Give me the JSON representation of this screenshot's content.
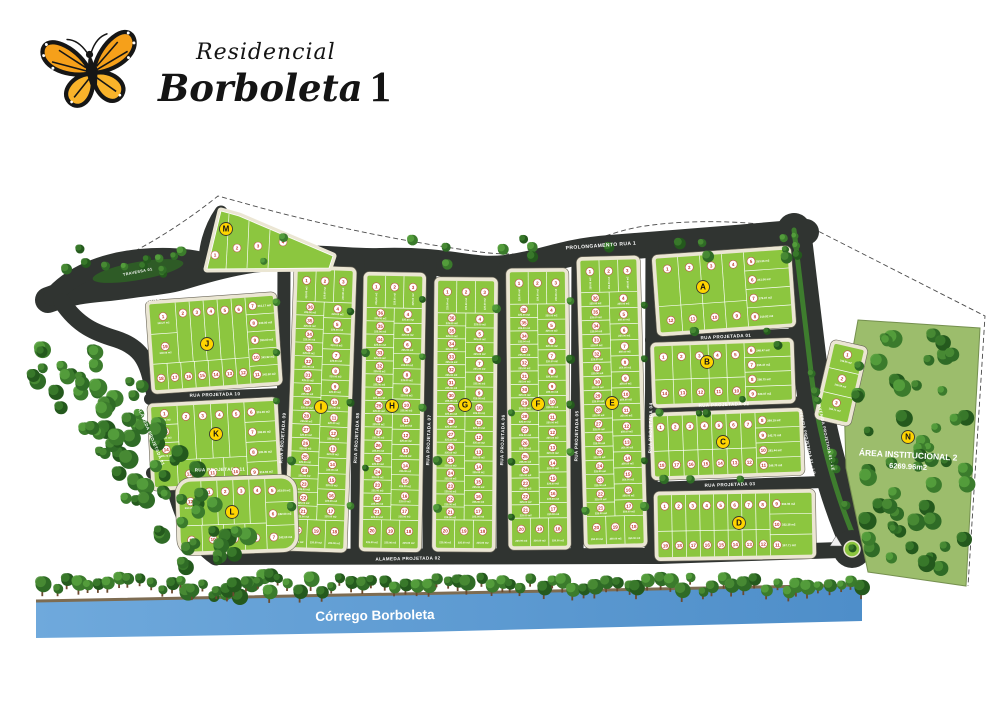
{
  "title": "Residencial Borboleta 1",
  "logo": {
    "script_line": "Residencial",
    "name_line": "Borboleta",
    "number": "1"
  },
  "map": {
    "colors": {
      "block_green": "#8CC63F",
      "road": "#303431",
      "sidewalk": "#EBE6D3",
      "badge_yellow": "#FFD400",
      "lot_number_red": "#C0392B",
      "river_light": "#6FA9DC",
      "river_dark": "#4E8EC9"
    },
    "river": {
      "label": "Córrego Borboleta"
    },
    "institutional_area": {
      "badge": "N",
      "badge_x": 908,
      "badge_y": 437,
      "x": 908,
      "y": 458,
      "rot": 3,
      "line1": "ÁREA INSTITUCIONAL 2",
      "line2": "6269.96m2"
    },
    "streets": [
      {
        "name": "PROLONGAMENTO RUA 1",
        "x": 168,
        "y": 298,
        "rot": -11,
        "size": 5
      },
      {
        "name": "PROLONGAMENTO RUA 1",
        "x": 601,
        "y": 247,
        "rot": -4,
        "size": 5
      },
      {
        "name": "TRAVESSA 01",
        "x": 138,
        "y": 273,
        "rot": -11,
        "size": 3.8
      },
      {
        "name": "RUA PROJETADA 10",
        "x": 215,
        "y": 396,
        "rot": -2,
        "size": 4.5
      },
      {
        "name": "RUA PROJETADA 11",
        "x": 220,
        "y": 471,
        "rot": -1,
        "size": 4.5
      },
      {
        "name": "RUA PROJETADA 09",
        "x": 284,
        "y": 438,
        "rot": -86,
        "size": 4.5
      },
      {
        "name": "RUA PROJETADA 08",
        "x": 358,
        "y": 438,
        "rot": -87,
        "size": 4.5
      },
      {
        "name": "RUA PROJETADA 07",
        "x": 430,
        "y": 440,
        "rot": -88,
        "size": 4.5
      },
      {
        "name": "RUA PROJETADA 06",
        "x": 504,
        "y": 440,
        "rot": -88,
        "size": 4.5
      },
      {
        "name": "RUA PROJETADA 05",
        "x": 578,
        "y": 436,
        "rot": -89,
        "size": 4.5
      },
      {
        "name": "RUA PROJETADA 04",
        "x": 652,
        "y": 428,
        "rot": -89,
        "size": 4.5
      },
      {
        "name": "RUA PROJETADA 01",
        "x": 726,
        "y": 338,
        "rot": -3,
        "size": 4.5
      },
      {
        "name": "RUA PROJETADA 02",
        "x": 724,
        "y": 406,
        "rot": -2,
        "size": 4.5
      },
      {
        "name": "RUA PROJETADA 03",
        "x": 730,
        "y": 486,
        "rot": -2,
        "size": 4.5
      },
      {
        "name": "AVENIDA PROJETADA 01 - LD",
        "x": 806,
        "y": 442,
        "rot": 78,
        "size": 4
      },
      {
        "name": "AVENIDA PROJETADA 01 - LE",
        "x": 825,
        "y": 438,
        "rot": 78,
        "size": 4
      },
      {
        "name": "ALAMEDA PROJETADA 01",
        "x": 150,
        "y": 437,
        "rot": 67,
        "size": 4.3
      },
      {
        "name": "ALAMEDA PROJETADA 02",
        "x": 408,
        "y": 560,
        "rot": -1,
        "size": 4.5
      }
    ],
    "strip_numbering": {
      "top": [
        "1",
        "2",
        "3"
      ],
      "bottom": [
        "20",
        "19",
        "18"
      ],
      "right_start": 4,
      "right_count": 14,
      "left_start": 21,
      "left_count": 16
    },
    "strip_blocks": [
      {
        "letter": "I",
        "badge": [
          321,
          407
        ],
        "x": 293,
        "y": 270,
        "w": 55,
        "h": 278,
        "rot": 2,
        "areaL": "225.00 m2",
        "areaR": "220.00 m2"
      },
      {
        "letter": "H",
        "badge": [
          392,
          406
        ],
        "x": 365,
        "y": 276,
        "w": 55,
        "h": 272,
        "rot": 1,
        "areaL": "225.00 m2",
        "areaR": "225.00 m2"
      },
      {
        "letter": "G",
        "badge": [
          465,
          405
        ],
        "x": 437,
        "y": 281,
        "w": 56,
        "h": 267,
        "rot": 0.5,
        "areaL": "225.00 m2",
        "areaR": "225.00 m2"
      },
      {
        "letter": "F",
        "badge": [
          538,
          404
        ],
        "x": 511,
        "y": 272,
        "w": 55,
        "h": 274,
        "rot": -0.5,
        "areaL": "225.00 m2",
        "areaR": "220.00 m2"
      },
      {
        "letter": "E",
        "badge": [
          612,
          403
        ],
        "x": 584,
        "y": 260,
        "w": 56,
        "h": 284,
        "rot": -1.5,
        "areaL": "225.00 m2",
        "areaR": "250.00 m2"
      }
    ],
    "perimeter_blocks": [
      {
        "letter": "J",
        "badge": [
          207,
          344
        ],
        "x": 152,
        "y": 300,
        "w": 124,
        "h": 86,
        "rot": -4,
        "leftW": 26,
        "rightW": 28,
        "left": [
          [
            "1",
            "360.27 m2"
          ],
          [
            "19",
            "248.06 m2"
          ]
        ],
        "top": [
          "2",
          "3",
          "4",
          "5",
          "6"
        ],
        "right": [
          [
            "7",
            "361.17 m2"
          ],
          [
            "8",
            "330.00 m2"
          ],
          [
            "9",
            "330.00 m2"
          ],
          [
            "10",
            "343.92 m2"
          ],
          [
            "11",
            "342.92 m2"
          ]
        ],
        "bottom": [
          "18",
          "17",
          "16",
          "15",
          "14",
          "13",
          "12"
        ]
      },
      {
        "letter": "K",
        "badge": [
          216,
          434
        ],
        "x": 153,
        "y": 404,
        "w": 123,
        "h": 80,
        "rot": -3,
        "leftW": 26,
        "rightW": 30,
        "left": [
          [
            "1",
            "317.32 m2"
          ],
          [
            "15",
            "298.41 m2"
          ],
          [
            "14",
            "305.72 m2"
          ]
        ],
        "top": [
          "2",
          "3",
          "4",
          "5"
        ],
        "right": [
          [
            "6",
            "319.30 m2"
          ],
          [
            "7",
            "298.90 m2"
          ],
          [
            "8",
            "305.00 m2"
          ],
          [
            "9",
            "312.92 m2"
          ]
        ],
        "bottom": [
          "13",
          "12",
          "11",
          "10"
        ]
      },
      {
        "letter": "L",
        "badge": [
          232,
          512
        ],
        "x": 180,
        "y": 480,
        "w": 114,
        "h": 70,
        "rot": -2,
        "leftW": 22,
        "rightW": 28,
        "round": 12,
        "left": [
          [
            "12",
            "232.08 m2"
          ]
        ],
        "top": [
          "1",
          "2",
          "3",
          "4"
        ],
        "right": [
          [
            "5",
            "253.00 m2"
          ],
          [
            "6",
            "242.00 m2"
          ],
          [
            "7",
            "242.00 m2"
          ]
        ],
        "bottom": [
          "11",
          "10",
          "9",
          "8"
        ]
      },
      {
        "letter": "A",
        "badge": [
          703,
          287
        ],
        "x": 658,
        "y": 254,
        "w": 132,
        "h": 74,
        "rot": -4,
        "leftW": 0,
        "rightW": 44,
        "top": [
          "1",
          "2",
          "3",
          "4"
        ],
        "right": [
          [
            "5",
            "253.36 m2"
          ],
          [
            "6",
            "241.06 m2"
          ],
          [
            "7",
            "279.97 m2"
          ],
          [
            "8",
            "219.82 m2"
          ]
        ],
        "bottom": [
          "12",
          "11",
          "10",
          "9"
        ]
      },
      {
        "letter": "B",
        "badge": [
          707,
          362
        ],
        "x": 655,
        "y": 344,
        "w": 136,
        "h": 58,
        "rot": -2,
        "leftW": 0,
        "rightW": 46,
        "top": [
          "1",
          "2",
          "3",
          "4",
          "5"
        ],
        "right": [
          [
            "6",
            "248.47 m2"
          ],
          [
            "7",
            "295.47 m2"
          ],
          [
            "8",
            "298.75 m2"
          ],
          [
            "9",
            "320.07 m2"
          ]
        ],
        "bottom": [
          "14",
          "13",
          "12",
          "11",
          "10"
        ]
      },
      {
        "letter": "C",
        "badge": [
          723,
          442
        ],
        "x": 654,
        "y": 414,
        "w": 146,
        "h": 60,
        "rot": -2,
        "leftW": 0,
        "rightW": 44,
        "top": [
          "1",
          "2",
          "3",
          "4",
          "5",
          "6",
          "7"
        ],
        "right": [
          [
            "8",
            "299.19 m2"
          ],
          [
            "9",
            "242.75 m2"
          ],
          [
            "10",
            "281.44 m2"
          ],
          [
            "11",
            "246.70 m2"
          ]
        ],
        "bottom": [
          "18",
          "17",
          "16",
          "15",
          "14",
          "13",
          "12"
        ]
      },
      {
        "letter": "D",
        "badge": [
          739,
          523
        ],
        "x": 658,
        "y": 494,
        "w": 154,
        "h": 62,
        "rot": -1,
        "leftW": 0,
        "rightW": 42,
        "top": [
          "1",
          "2",
          "3",
          "4",
          "5",
          "6",
          "7",
          "8"
        ],
        "right": [
          [
            "9",
            "360.06 m2"
          ],
          [
            "10",
            "332.38 m2"
          ],
          [
            "11",
            "367.71 m2"
          ]
        ],
        "bottom": [
          "19",
          "18",
          "17",
          "16",
          "15",
          "14",
          "13",
          "12"
        ]
      }
    ],
    "fan_block": {
      "letter": "M",
      "badge": [
        226,
        229
      ],
      "pts": "207,269 221,211 239,216 333,256 329,268",
      "dividers": [
        [
          229,
          214,
          226,
          269
        ],
        [
          249,
          221,
          247,
          268
        ],
        [
          270,
          230,
          268,
          268
        ]
      ],
      "lots": [
        [
          "1",
          215,
          255
        ],
        [
          "2",
          237,
          248
        ],
        [
          "3",
          258,
          246
        ],
        [
          "4",
          283,
          242
        ]
      ]
    },
    "stack_block": {
      "x": 826,
      "y": 346,
      "w": 30,
      "h": 74,
      "rot": 13,
      "lots": [
        [
          "1",
          "248.95 m2"
        ],
        [
          "2",
          "248.98 m2"
        ],
        [
          "3",
          "266.71 m2"
        ]
      ]
    }
  }
}
